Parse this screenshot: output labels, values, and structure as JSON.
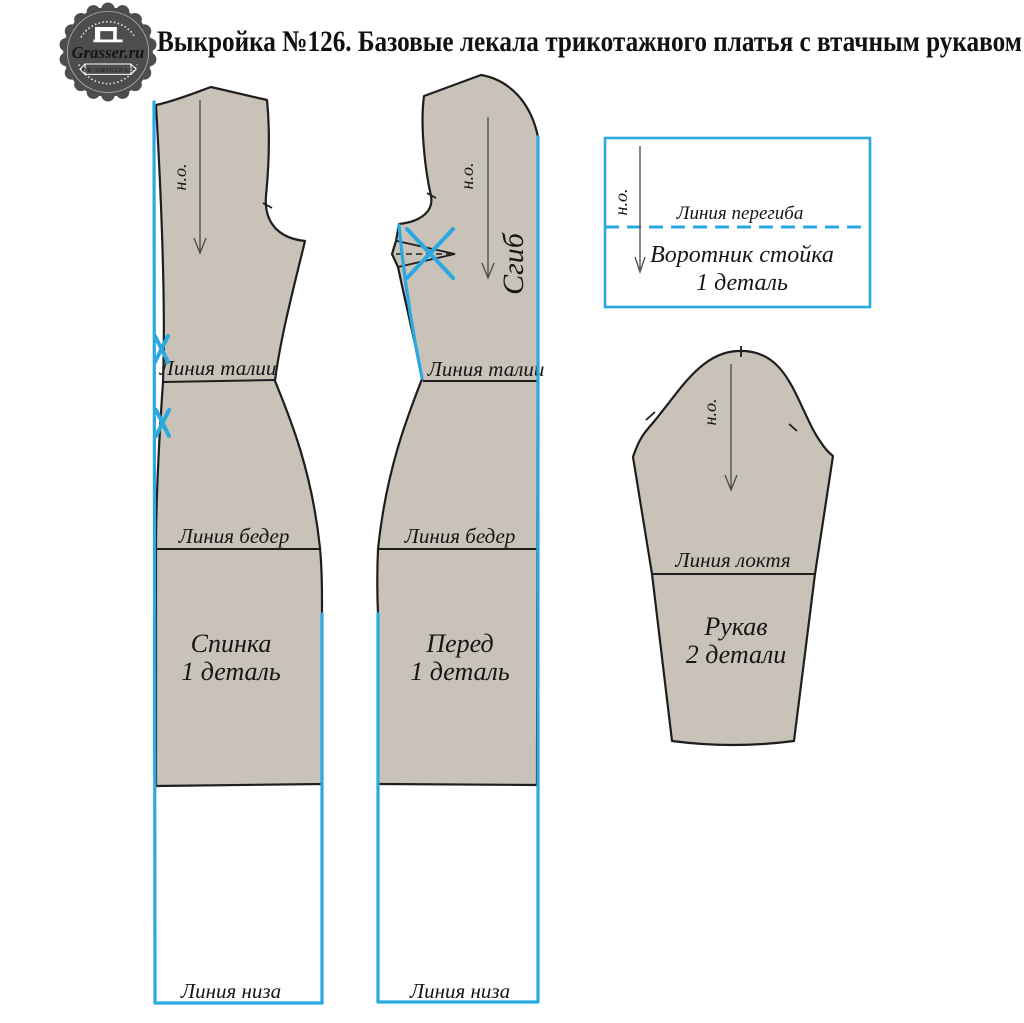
{
  "header": {
    "title": "Выкройка №126. Базовые лекала трикотажного платья с втачным рукавом"
  },
  "logo": {
    "brand": "Grasser.ru",
    "tagline": "BE ORIGINAL"
  },
  "labels": {
    "grain": "н.о.",
    "waist": "Линия талии",
    "hips": "Линия бедер",
    "hem": "Линия низа",
    "fold": "Сгиб",
    "fold_line": "Линия перегиба",
    "elbow": "Линия локтя"
  },
  "pieces": {
    "back": {
      "name": "Спинка",
      "count": "1 деталь"
    },
    "front": {
      "name": "Перед",
      "count": "1 деталь"
    },
    "collar": {
      "name": "Воротник стойка",
      "count": "1 деталь"
    },
    "sleeve": {
      "name": "Рукав",
      "count": "2 детали"
    }
  },
  "colors": {
    "fabric_fill": "#c8c2b9",
    "outline": "#1e1e1e",
    "accent_blue": "#29a9e0",
    "logo_gray": "#4d4d4d"
  }
}
